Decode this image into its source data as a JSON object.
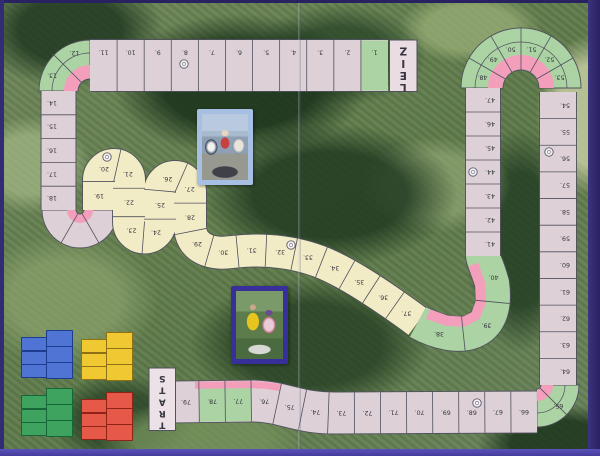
{
  "board_labels": {
    "finish": "ZIEL",
    "start": "START"
  },
  "track_spaces": {
    "top_row": [
      "1.",
      "2.",
      "3.",
      "4.",
      "5.",
      "6.",
      "7.",
      "8.",
      "9.",
      "10.",
      "11."
    ],
    "top_left_corner": [
      "12.",
      "13."
    ],
    "left_column": [
      "14.",
      "15.",
      "16.",
      "17.",
      "18."
    ],
    "serpentine_climb": [
      "19.",
      "20.",
      "21.",
      "22.",
      "23.",
      "24.",
      "25.",
      "26.",
      "27.",
      "28.",
      "29.",
      "30.",
      "31.",
      "32.",
      "33.",
      "34.",
      "35.",
      "36.",
      "37."
    ],
    "right_bend": [
      "38.",
      "39.",
      "40."
    ],
    "right_inner_column": [
      "41.",
      "42.",
      "43.",
      "44.",
      "45.",
      "46.",
      "47."
    ],
    "hairpin_turn": [
      "48.",
      "49.",
      "50.",
      "51.",
      "52.",
      "53."
    ],
    "right_outer_column": [
      "54.",
      "55.",
      "56.",
      "57.",
      "58.",
      "59.",
      "60.",
      "61.",
      "62.",
      "63.",
      "64."
    ],
    "bottom_right_corner": [
      "65."
    ],
    "bottom_row": [
      "66.",
      "67.",
      "68.",
      "69.",
      "70.",
      "71.",
      "72.",
      "73.",
      "74.",
      "75.",
      "76.",
      "77.",
      "78.",
      "79."
    ]
  },
  "circled_spaces": [
    "8",
    "20",
    "32",
    "44",
    "56",
    "68"
  ],
  "colors": {
    "track_cell": "#ddd1d7",
    "curve_green": "#abd3a3",
    "curve_pink": "#f39fbc",
    "mountain_yellow": "#f2ecc6",
    "finish_cell": "#e9dde3",
    "start_cell": "#ebe1e6",
    "frame_purple": "#38327e"
  },
  "icons": {
    "circle_marker": "circle-marker-icon"
  },
  "photo_cards": [
    {
      "name": "cyclists-photo-card-1",
      "description": "photo card: cyclists racing"
    },
    {
      "name": "cyclists-photo-card-2",
      "description": "photo card: rider in yellow jersey"
    }
  ],
  "card_stacks": [
    {
      "color": "blue",
      "cards": 6,
      "fill": "#4f74d4",
      "border": "#1d3c8f"
    },
    {
      "color": "yellow",
      "cards": 6,
      "fill": "#f0c832",
      "border": "#8f7015"
    },
    {
      "color": "green",
      "cards": 6,
      "fill": "#3da35e",
      "border": "#17663a"
    },
    {
      "color": "red",
      "cards": 6,
      "fill": "#e65848",
      "border": "#8f2318"
    }
  ]
}
